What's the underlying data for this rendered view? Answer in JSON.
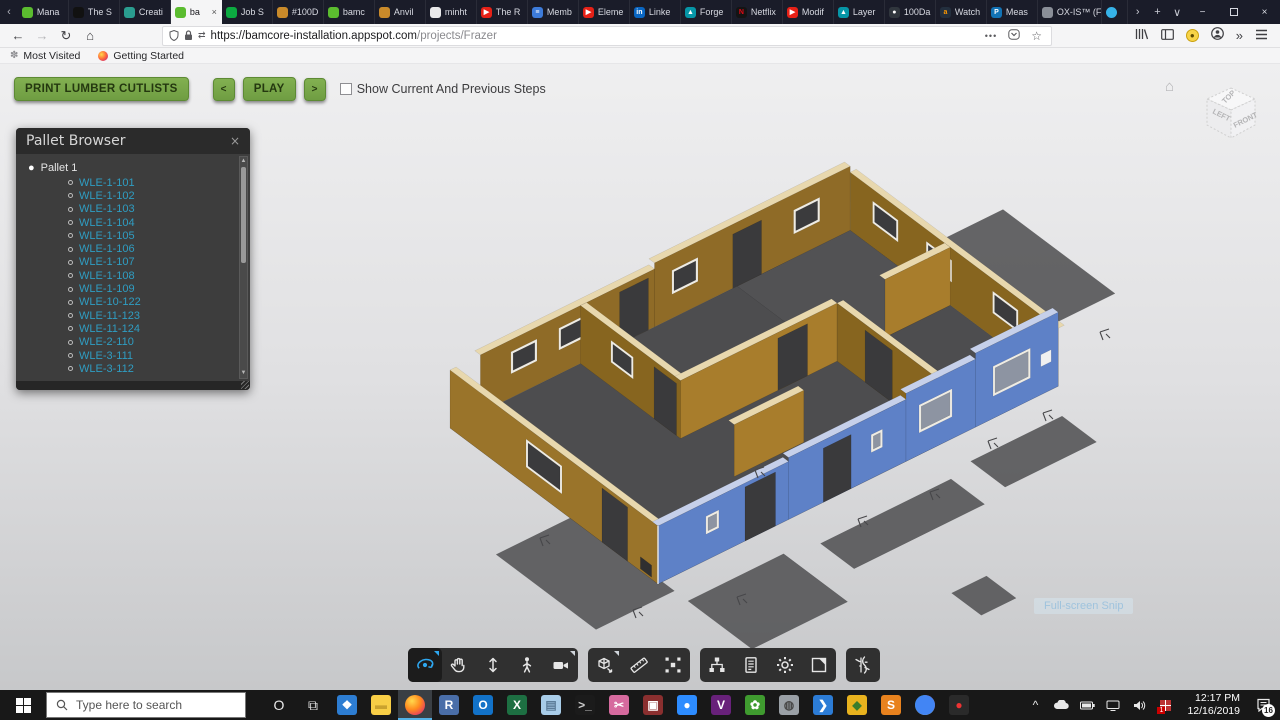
{
  "browser": {
    "tabs": [
      {
        "label": "Mana",
        "icon": "upwork-icon",
        "color": "#5bbc2f"
      },
      {
        "label": "The S",
        "icon": "bloomberg-icon",
        "color": "#111111"
      },
      {
        "label": "Creati",
        "icon": "shield-icon",
        "color": "#2a9d8f"
      },
      {
        "label": "ba",
        "icon": "bamcore-icon",
        "color": "#5bbc2f",
        "active": true,
        "close": "×"
      },
      {
        "label": "Job S",
        "icon": "glassdoor-icon",
        "color": "#0caa41"
      },
      {
        "label": "#100D",
        "icon": "beer-icon",
        "color": "#c98a2a"
      },
      {
        "label": "bamc",
        "icon": "bamcore-icon",
        "color": "#5bbc2f"
      },
      {
        "label": "Anvil",
        "icon": "beer-icon",
        "color": "#c98a2a"
      },
      {
        "label": "minht",
        "icon": "github-icon",
        "color": "#e8e8ea",
        "fg": "#222"
      },
      {
        "label": "The R",
        "icon": "youtube-icon",
        "color": "#e62117",
        "glyph": "▶"
      },
      {
        "label": "Memb",
        "icon": "list-icon",
        "color": "#3d7bd9",
        "glyph": "≡"
      },
      {
        "label": "Eleme",
        "icon": "youtube-icon",
        "color": "#e62117",
        "glyph": "▶"
      },
      {
        "label": "Linke",
        "icon": "linkedin-icon",
        "color": "#0a66c2",
        "glyph": "in"
      },
      {
        "label": "Forge",
        "icon": "autodesk-icon",
        "color": "#0696a7",
        "glyph": "▲"
      },
      {
        "label": "Netflix",
        "icon": "netflix-icon",
        "color": "#141414",
        "fg": "#e50914",
        "glyph": "N"
      },
      {
        "label": "Modif",
        "icon": "youtube-icon",
        "color": "#e62117",
        "glyph": "▶"
      },
      {
        "label": "Layer",
        "icon": "autodesk-icon",
        "color": "#0696a7",
        "glyph": "▲"
      },
      {
        "label": "100Da",
        "icon": "github-icon",
        "color": "#30363d",
        "glyph": "●"
      },
      {
        "label": "Watch",
        "icon": "amazon-icon",
        "color": "#232f3e",
        "fg": "#ff9900",
        "glyph": "a"
      },
      {
        "label": "Meas",
        "icon": "pluralsight-icon",
        "color": "#1273b5",
        "glyph": "P"
      },
      {
        "label": "OX-IS™ (F",
        "icon": "doc-icon",
        "color": "#8a8f98",
        "wide": true
      },
      {
        "label": "",
        "icon": "blue-dot-icon",
        "color": "#36b3e8",
        "mini": true
      }
    ],
    "tab_controls": {
      "scroll_left": "‹",
      "scroll_right": "›",
      "new_tab": "+",
      "list_tabs": "∨"
    },
    "window_controls": {
      "minimize": "−",
      "close": "×"
    },
    "nav": {
      "back": "←",
      "forward": "→",
      "reload": "↻",
      "home": "⌂",
      "url_bold": "https://bamcore-installation.appspot.com",
      "url_path": "/projects/Frazer",
      "page_actions": "•••",
      "bookmark_star": "☆",
      "overflow": "»"
    },
    "bookmarks": {
      "most_visited": "Most Visited",
      "getting_started": "Getting Started"
    }
  },
  "app": {
    "toolbar": {
      "print": "PRINT LUMBER CUTLISTS",
      "prev": "<",
      "play": "PLAY",
      "next": ">",
      "checkbox_label": "Show Current And Previous Steps",
      "checkbox_checked": false
    },
    "pallet_browser": {
      "title": "Pallet Browser",
      "close": "×",
      "group": "Pallet 1",
      "items": [
        "WLE-1-101",
        "WLE-1-102",
        "WLE-1-103",
        "WLE-1-104",
        "WLE-1-105",
        "WLE-1-106",
        "WLE-1-107",
        "WLE-1-108",
        "WLE-1-109",
        "WLE-10-122",
        "WLE-11-123",
        "WLE-11-124",
        "WLE-2-110",
        "WLE-3-111",
        "WLE-3-112"
      ],
      "link_color": "#2f9dc2"
    },
    "viewcube": {
      "top": "TOP",
      "left": "LEFT",
      "front": "FRONT"
    },
    "viewer_toolbar": {
      "groups": [
        {
          "buttons": [
            {
              "name": "orbit-tool",
              "active": true,
              "flyout": true
            },
            {
              "name": "pan-tool"
            },
            {
              "name": "zoom-tool"
            },
            {
              "name": "first-person-tool"
            },
            {
              "name": "camera-tool",
              "flyout": true
            }
          ]
        },
        {
          "buttons": [
            {
              "name": "model-views-tool",
              "flyout": true
            },
            {
              "name": "measure-tool"
            },
            {
              "name": "explode-tool"
            }
          ]
        },
        {
          "buttons": [
            {
              "name": "model-browser-tool"
            },
            {
              "name": "properties-tool"
            },
            {
              "name": "settings-tool"
            },
            {
              "name": "fullscreen-tool"
            }
          ]
        },
        {
          "buttons": [
            {
              "name": "bamcore-tool"
            }
          ]
        }
      ],
      "accent": "#2ea7f0"
    },
    "snip_label": "Full-screen Snip",
    "model_colors": {
      "wall_tan": "#a87d2c",
      "wall_blue": "#5e81c7",
      "floor": "#4d4d4f",
      "top_edge": "#e8d8ae"
    }
  },
  "taskbar": {
    "search_placeholder": "Type here to search",
    "apps": [
      {
        "name": "cortana-icon",
        "bg": "transparent",
        "glyph": "O",
        "fg": "#e8e8e8"
      },
      {
        "name": "task-view-icon",
        "bg": "transparent",
        "glyph": "⧉",
        "fg": "#e8e8e8"
      },
      {
        "name": "dropbox-icon",
        "bg": "#2d7dd2",
        "glyph": "❖"
      },
      {
        "name": "file-explorer-icon",
        "bg": "#f8ce46",
        "glyph": "▬",
        "fg": "#caa22e"
      },
      {
        "name": "firefox-icon",
        "bg": "radial",
        "glyph": "",
        "active": true
      },
      {
        "name": "rstudio-icon",
        "bg": "#4a6ea8",
        "glyph": "R"
      },
      {
        "name": "outlook-icon",
        "bg": "#1272c8",
        "glyph": "O"
      },
      {
        "name": "excel-icon",
        "bg": "#1d6f42",
        "glyph": "X"
      },
      {
        "name": "sticky-notes-icon",
        "bg": "#a8cce8",
        "glyph": "▤",
        "fg": "#5d7d99"
      },
      {
        "name": "command-prompt-icon",
        "bg": "#1b1b1b",
        "glyph": ">_",
        "fg": "#cfcfcf"
      },
      {
        "name": "snipping-tool-icon",
        "bg": "#d66a9e",
        "glyph": "✂"
      },
      {
        "name": "screen-recorder-icon",
        "bg": "#8a2f2f",
        "glyph": "▣"
      },
      {
        "name": "zoom-app-icon",
        "bg": "#2d8cff",
        "glyph": "●"
      },
      {
        "name": "visual-studio-icon",
        "bg": "#68217a",
        "glyph": "V"
      },
      {
        "name": "bamcore-app-icon",
        "bg": "#3f9b2f",
        "glyph": "✿"
      },
      {
        "name": "sketchup-icon",
        "bg": "#9aa0a6",
        "glyph": "◍",
        "fg": "#4a4a4a"
      },
      {
        "name": "vscode-icon",
        "bg": "#2c7cd6",
        "glyph": "❯"
      },
      {
        "name": "kite-icon",
        "bg": "#e8b21e",
        "glyph": "◆",
        "fg": "#3a7d2c"
      },
      {
        "name": "sublime-text-icon",
        "bg": "#e8821e",
        "glyph": "S"
      },
      {
        "name": "chrome-icon",
        "bg": "conic",
        "glyph": ""
      },
      {
        "name": "recorder-icon",
        "bg": "#2a2a2a",
        "glyph": "●",
        "fg": "#e33"
      }
    ],
    "tray": {
      "chevron": "^",
      "badge_1": "1",
      "time": "12:17 PM",
      "date": "12/16/2019",
      "notif_count": "16"
    }
  }
}
